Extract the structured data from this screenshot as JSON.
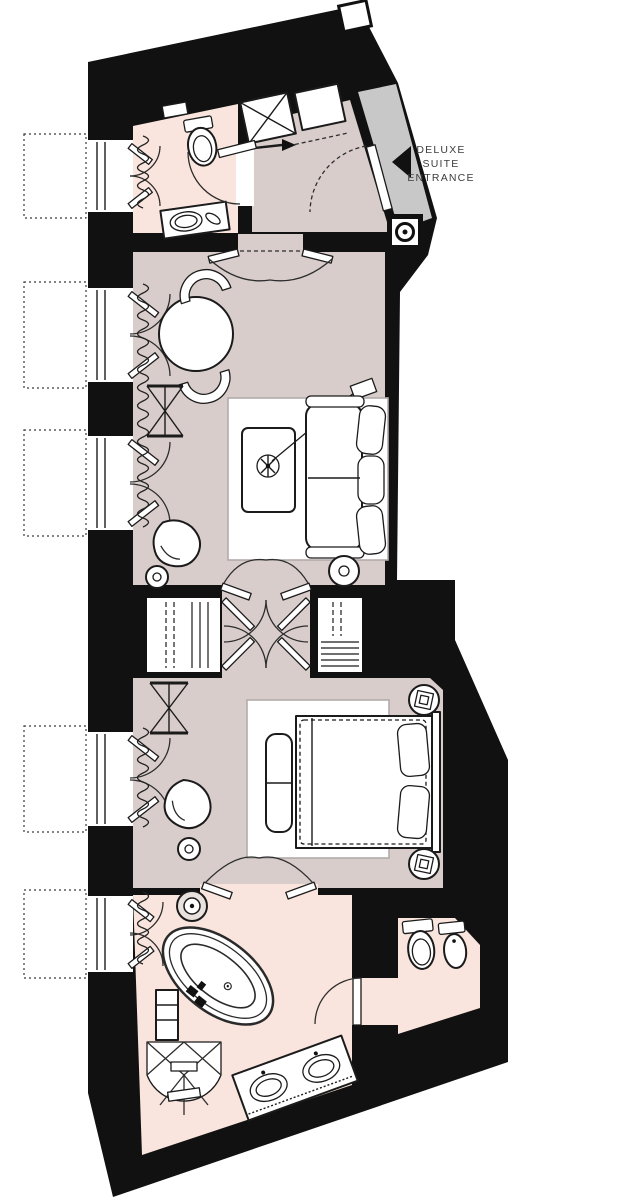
{
  "plan": {
    "title": "Deluxe Suite floor plan",
    "entrance_label": {
      "line1": "DELUXE",
      "line2": "SUITE",
      "line3": "ENTRANCE"
    },
    "entrance_arrow_direction": "left"
  },
  "colors": {
    "wall": "#111111",
    "floor_main": "#d8cdcb",
    "floor_bath": "#f9e5dd",
    "floor_entry": "#c8c8c8",
    "paper": "#ffffff"
  },
  "rooms": [
    {
      "name": "entrance-hall",
      "furniture": [
        "entrance-door",
        "service-shaft",
        "closet",
        "door-detail"
      ]
    },
    {
      "name": "guest-bathroom",
      "furniture": [
        "toilet",
        "washbasin-vanity",
        "wall-shelf",
        "window"
      ]
    },
    {
      "name": "living-room",
      "furniture": [
        "round-dining-table",
        "chair",
        "chair",
        "sofa",
        "coffee-table",
        "plant",
        "rug",
        "armchair",
        "side-table",
        "round-table",
        "luggage-rack",
        "french-window",
        "french-window"
      ]
    },
    {
      "name": "wardrobe-corridor",
      "furniture": [
        "hanging-wardrobe",
        "shelved-wardrobe",
        "double-doors"
      ]
    },
    {
      "name": "bedroom",
      "furniture": [
        "double-bed",
        "pillow",
        "pillow",
        "bench",
        "nightstand",
        "nightstand",
        "rug",
        "armchair",
        "round-table",
        "luggage-rack",
        "french-window"
      ]
    },
    {
      "name": "main-bathroom",
      "furniture": [
        "freestanding-bathtub",
        "double-vanity",
        "shower",
        "stool",
        "cabinet",
        "window"
      ]
    },
    {
      "name": "wc",
      "furniture": [
        "toilet",
        "bidet"
      ]
    }
  ]
}
